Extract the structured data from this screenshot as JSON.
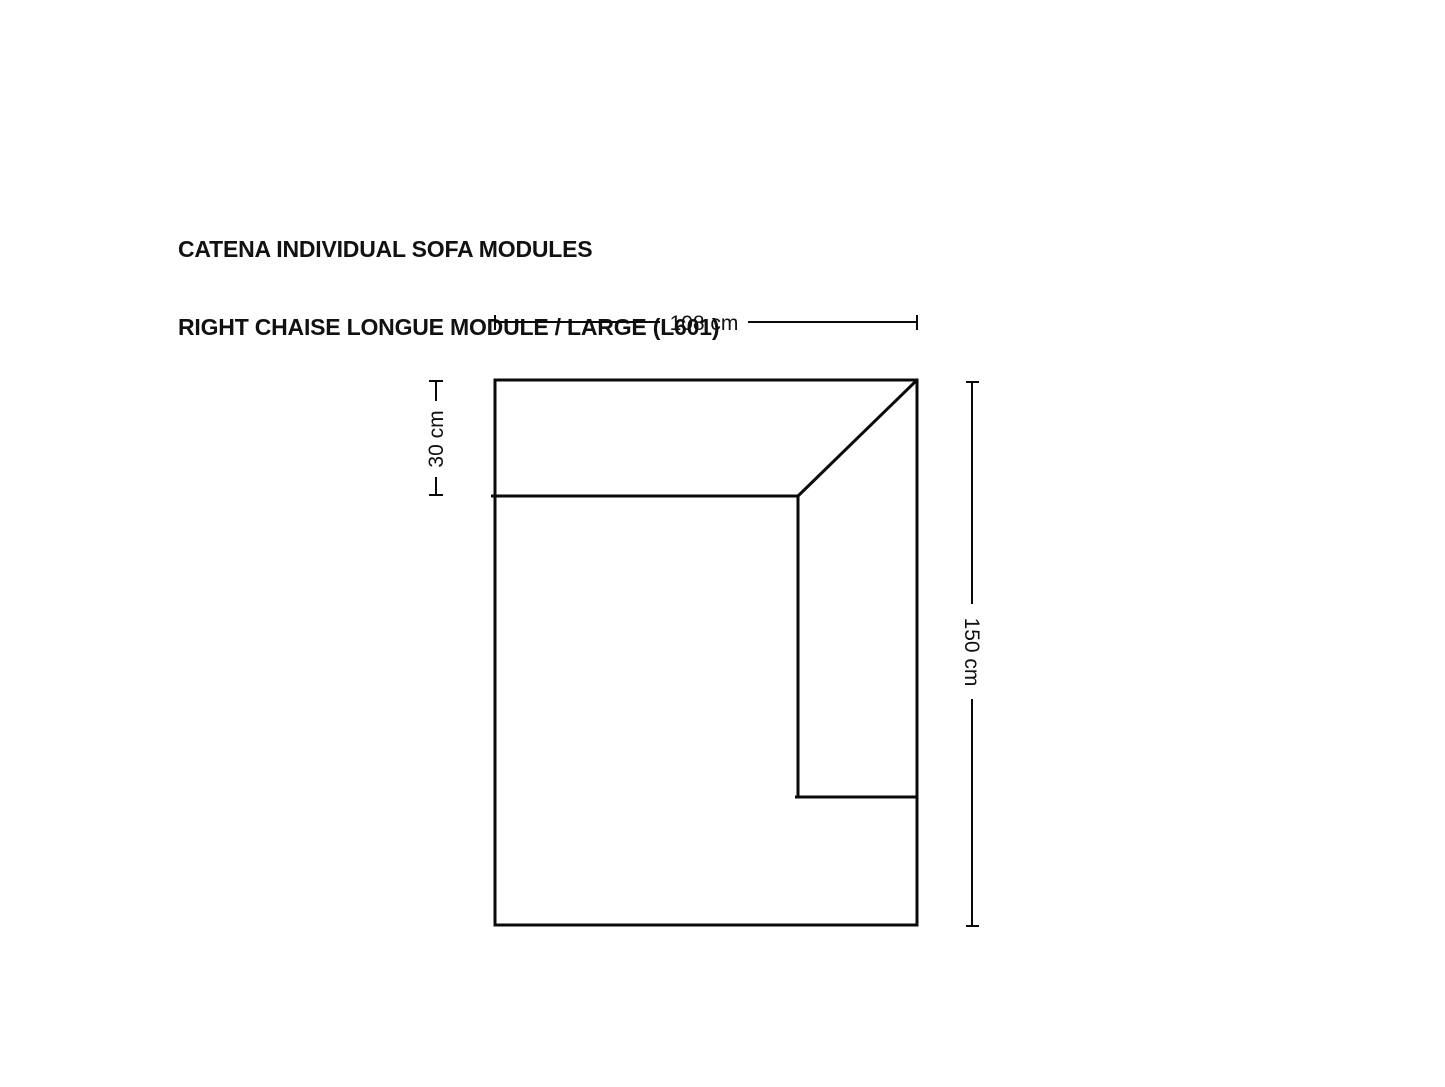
{
  "colors": {
    "background": "#ffffff",
    "line": "#0a0a0a",
    "text": "#111111"
  },
  "header": {
    "title_line1": "CATENA INDIVIDUAL SOFA MODULES",
    "title_line2": "RIGHT CHAISE LONGUE MODULE / LARGE (L601)"
  },
  "diagram": {
    "dimensions": {
      "width": {
        "label": "108 cm",
        "value": 108,
        "unit": "cm"
      },
      "backrest_depth": {
        "label": "30 cm",
        "value": 30,
        "unit": "cm"
      },
      "depth": {
        "label": "150 cm",
        "value": 150,
        "unit": "cm"
      }
    }
  }
}
